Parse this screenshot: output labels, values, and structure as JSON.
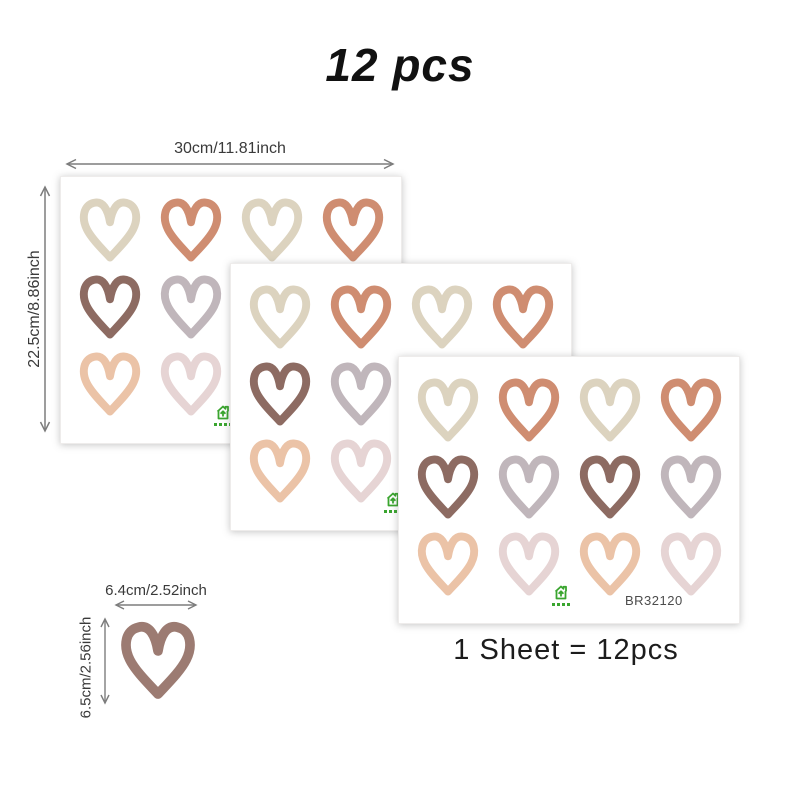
{
  "title": "12 pcs",
  "note": "1 Sheet = 12pcs",
  "product_code": "BR32120",
  "dimensions": {
    "sheet_width": "30cm/11.81inch",
    "sheet_height": "22.5cm/8.86inch",
    "heart_width": "6.4cm/2.52inch",
    "heart_height": "6.5cm/2.56inch"
  },
  "colors": {
    "hearts": {
      "beige": "#dcd3bf",
      "terracotta": "#cf8d71",
      "brown": "#8d6b62",
      "mauve": "#c0b6bb",
      "peach": "#ebc3a7",
      "dusty-pink": "#e6d4d4"
    },
    "single_heart": "#9c7b72",
    "arrow": "#7d7d7d",
    "logo_green": "#3aa52f"
  },
  "heart_grid": [
    [
      "beige",
      "terracotta",
      "beige",
      "terracotta"
    ],
    [
      "brown",
      "mauve",
      "brown",
      "mauve"
    ],
    [
      "peach",
      "dusty-pink",
      "peach",
      "dusty-pink"
    ]
  ],
  "sheets_count": 3,
  "hearts_per_sheet": 12
}
